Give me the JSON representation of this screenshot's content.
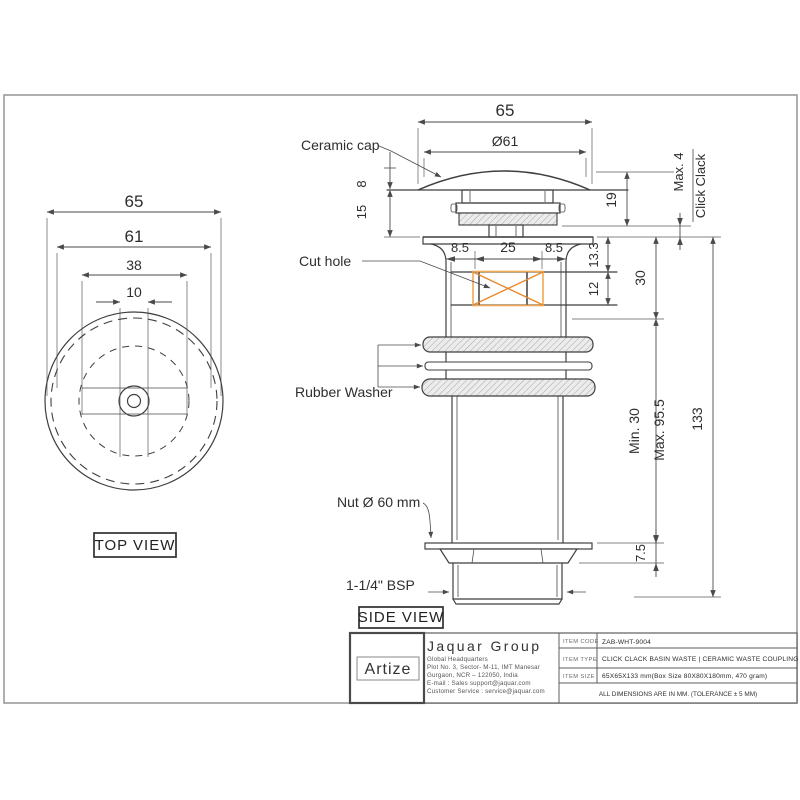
{
  "colors": {
    "line": "#3f3f3f",
    "border": "#9b9b9b",
    "cut_hole_frame": "#f0a854",
    "cut_hole_cross": "#e8882a",
    "logo_gold": "#bf9e3e",
    "hatch_fill": "#ececec"
  },
  "top_view": {
    "label": "TOP VIEW",
    "dims": {
      "d65": "65",
      "d61": "61",
      "d38": "38",
      "d10": "10"
    }
  },
  "side_view": {
    "label": "SIDE VIEW",
    "callouts": {
      "ceramic_cap": "Ceramic cap",
      "cut_hole": "Cut hole",
      "rubber_washer": "Rubber Washer",
      "nut": "Nut Ø 60 mm",
      "thread": "1-1/4\" BSP"
    },
    "dims": {
      "width": "65",
      "cap_dia": "Ø61",
      "cap_h": "8",
      "neck_h": "15",
      "gap": "19",
      "max_travel": "Max. 4",
      "mechanism": "Click Clack",
      "off_left": "8.5",
      "hole_w": "25",
      "off_right": "8.5",
      "depth_top": "13.3",
      "hole_h": "12",
      "upper_h": "30",
      "min_clamp": "Min. 30",
      "max_clamp": "Max. 95.5",
      "total_h": "133",
      "nut_h": "7.5"
    }
  },
  "title_block": {
    "logo": "Artize",
    "company": "Jaquar Group",
    "address": [
      "Global Headquarters",
      "Plot No. 3, Sector- M-11, IMT Manesar",
      "Gurgaon, NCR – 122050, India",
      "E-mail : Sales support@jaquar.com",
      "Customer Service : service@jaquar.com"
    ],
    "rows": [
      {
        "label": "ITEM CODE",
        "value": "ZAB-WHT-9004"
      },
      {
        "label": "ITEM TYPE",
        "value": "CLICK CLACK BASIN WASTE | CERAMIC WASTE COUPLING"
      },
      {
        "label": "ITEM SIZE",
        "value": "65X65X133 mm(Box Size 80X80X180mm, 470 gram)"
      }
    ],
    "footnote": "ALL DIMENSIONS ARE IN MM. (TOLERANCE ± 5 MM)"
  }
}
